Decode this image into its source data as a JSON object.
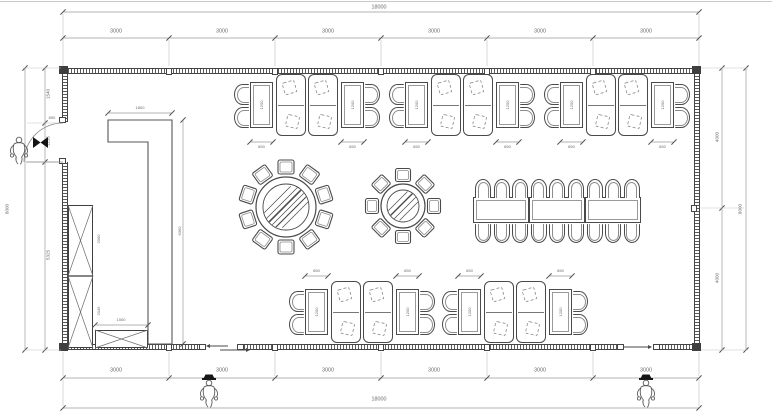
{
  "title": "banquet-hall-floor-plan",
  "dims": {
    "top_total": "18000",
    "top_segments": [
      "3000",
      "3000",
      "3000",
      "3000",
      "3000",
      "3000"
    ],
    "bottom_segments": [
      "3000",
      "3000",
      "3000",
      "3000",
      "3000",
      "3000"
    ],
    "bottom_total": "18000",
    "left_total": "8000",
    "left_segments": [
      "1540",
      "1135",
      "5325"
    ],
    "door_width": "890",
    "right_segments": [
      "4000",
      "4000"
    ],
    "right_total": "8000",
    "partition_width": "1800",
    "partition_length": "6360",
    "cabinet_upper": "2000",
    "cabinet_lower": "2045",
    "low_cabinet_width": "1500",
    "booth_table_width": "650",
    "booth_table_length": "1200"
  },
  "furniture": {
    "top_booth_clusters": 3,
    "bottom_booth_clusters": 2,
    "round_table_large_seats": 10,
    "round_table_small_seats": 8,
    "banquet_sections": 3,
    "banquet_seats_per_side": 9,
    "tall_cabinet_sections": 2,
    "low_cabinet_sections": 1
  },
  "markers": {
    "entry_left": "person-figure",
    "entry_bottom_center": "person-figure",
    "entry_bottom_right": "person-figure"
  }
}
